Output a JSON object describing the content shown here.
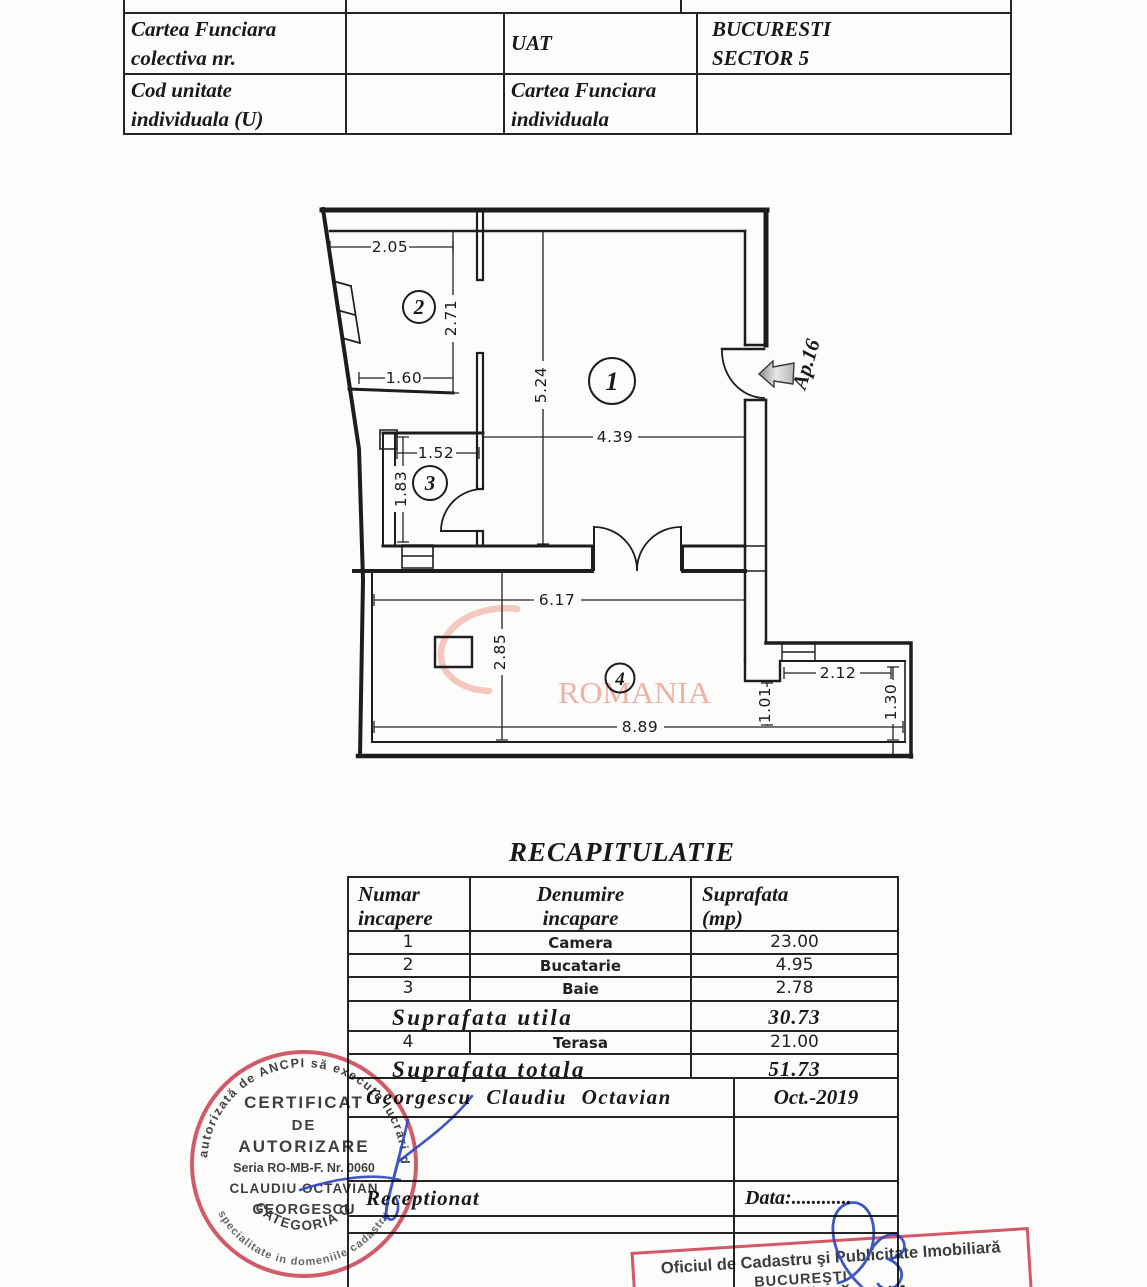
{
  "doc": {
    "top_table": {
      "r1c1a": "Cartea Funciara",
      "r1c1b": "colectiva nr.",
      "r1c3": "UAT",
      "r1c4a": "BUCURESTI",
      "r1c4b": "SECTOR 5",
      "r2c1a": "Cod unitate",
      "r2c1b": "individuala (U)",
      "r2c3a": "Cartea Funciara",
      "r2c3b": "individuala"
    },
    "plan": {
      "room1": "1",
      "room2": "2",
      "room3": "3",
      "room4": "4",
      "dims": {
        "d205": "2.05",
        "d271": "2.71",
        "d160": "1.60",
        "d524": "5.24",
        "d439": "4.39",
        "d152": "1.52",
        "d183": "1.83",
        "d617": "6.17",
        "d285": "2.85",
        "d889": "8.89",
        "d212": "2.12",
        "d101": "1.01",
        "d130": "1.30"
      },
      "apartment_label": "Ap.16",
      "watermark": "ROMANIA"
    },
    "recap": {
      "title": "RECAPITULATIE",
      "col1a": "Numar",
      "col1b": "incapere",
      "col2a": "Denumire",
      "col2b": "incapare",
      "col3a": "Suprafata",
      "col3b": "(mp)",
      "rows": [
        {
          "num": "1",
          "name": "Camera",
          "area": "23.00"
        },
        {
          "num": "2",
          "name": "Bucatarie",
          "area": "4.95"
        },
        {
          "num": "3",
          "name": "Baie",
          "area": "2.78"
        }
      ],
      "utila_label": "Suprafata utila",
      "utila_value": "30.73",
      "row4": {
        "num": "4",
        "name": "Terasa",
        "area": "21.00"
      },
      "totala_label": "Suprafata totala",
      "totala_value": "51.73",
      "author": "Georgescu Claudiu Octavian",
      "date": "Oct.-2019",
      "reception_label": "Receptionat",
      "data_label": "Data:............"
    },
    "stamps": {
      "cert": {
        "ring_top": "autorizată de ANCPI să execute lucrări de",
        "ring_bottom": "specialitate in domeniile cadastru, geodezie",
        "l1": "CERTIFICAT",
        "l2": "DE",
        "l3": "AUTORIZARE",
        "l4": "Seria RO-MB-F. Nr. 0060",
        "l5": "CLAUDIU OCTAVIAN",
        "l6": "GEORGESCU",
        "cat": "CATEGORIA C"
      },
      "ocpi": {
        "l1": "Oficiul de Cadastru şi Publicitate Imobiliară",
        "l2": "BUCUREŞTI",
        "l3": "MBUZA MĂDĂLINA"
      }
    }
  }
}
